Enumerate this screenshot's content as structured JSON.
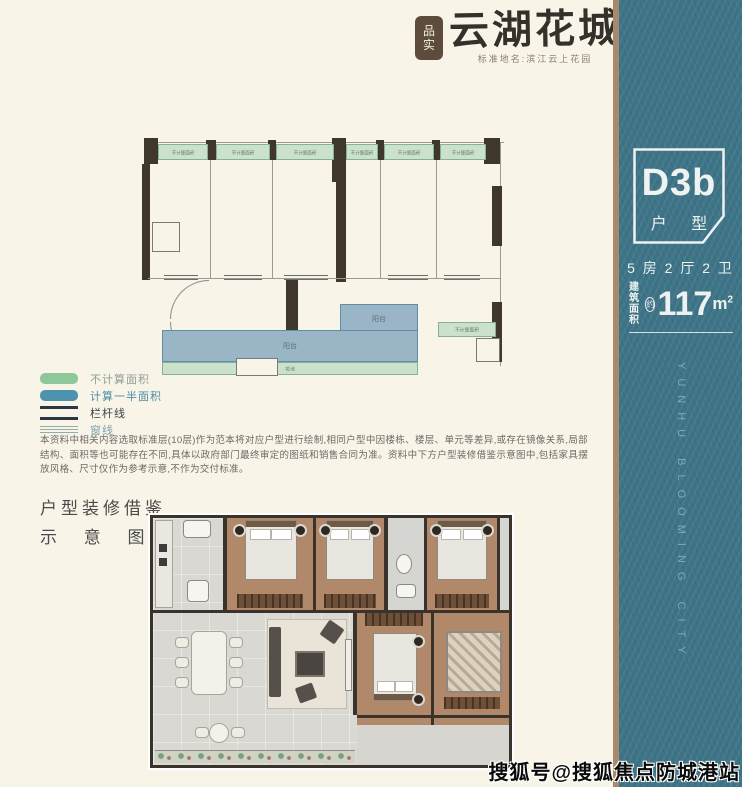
{
  "brand": {
    "seal_top": "品",
    "seal_bottom": "实",
    "logo_text": "云湖花城",
    "subtitle": "标准地名:滨江云上花园"
  },
  "sidebar": {
    "unit_code": "D3b",
    "unit_type_label": "户 型",
    "layout_summary": "5 房 2 厅 2 卫",
    "area_label_line1": "建筑",
    "area_label_line2": "面积",
    "area_approx": "约",
    "area_value": "117",
    "area_unit": "m",
    "area_sup": "2",
    "vertical_text": "YUNHU BLOOMING CITY",
    "accent_teal": "#3e7487",
    "divider_tan": "#a8896c"
  },
  "floorplan": {
    "strip_labels": [
      "不计算面积",
      "不计算面积",
      "不计算面积",
      "不计算面积",
      "不计算面积",
      "不计算面积"
    ],
    "right_strip_label": "不计算面积",
    "balcony_label_left": "阳台",
    "balcony_label_right": "阳台",
    "flowerbed_label": "花池"
  },
  "legend": {
    "items": [
      {
        "label": "不计算面积",
        "color": "#8ec79a"
      },
      {
        "label": "计算一半面积",
        "color": "#4e93ad"
      },
      {
        "label": "栏杆线",
        "color": "#2c3640"
      },
      {
        "label": "窗线",
        "color": "#8fb0a8"
      }
    ]
  },
  "disclaimer": "本资料中相关内容选取标准层(10层)作为范本将对应户型进行绘制,相同户型中因楼栋、楼层、单元等差异,或存在镜像关系,局部结构、面积等也可能存在不同,具体以政府部门最终审定的图纸和销售合同为准。资料中下方户型装修借鉴示意图中,包括家具摆放风格、尺寸仅作为参考示意,不作为交付标准。",
  "section": {
    "title_line1": "户型装修借鉴",
    "title_line2": "示 意 图",
    "marker": "◢"
  },
  "watermark": "搜狐号@搜狐焦点防城港站"
}
